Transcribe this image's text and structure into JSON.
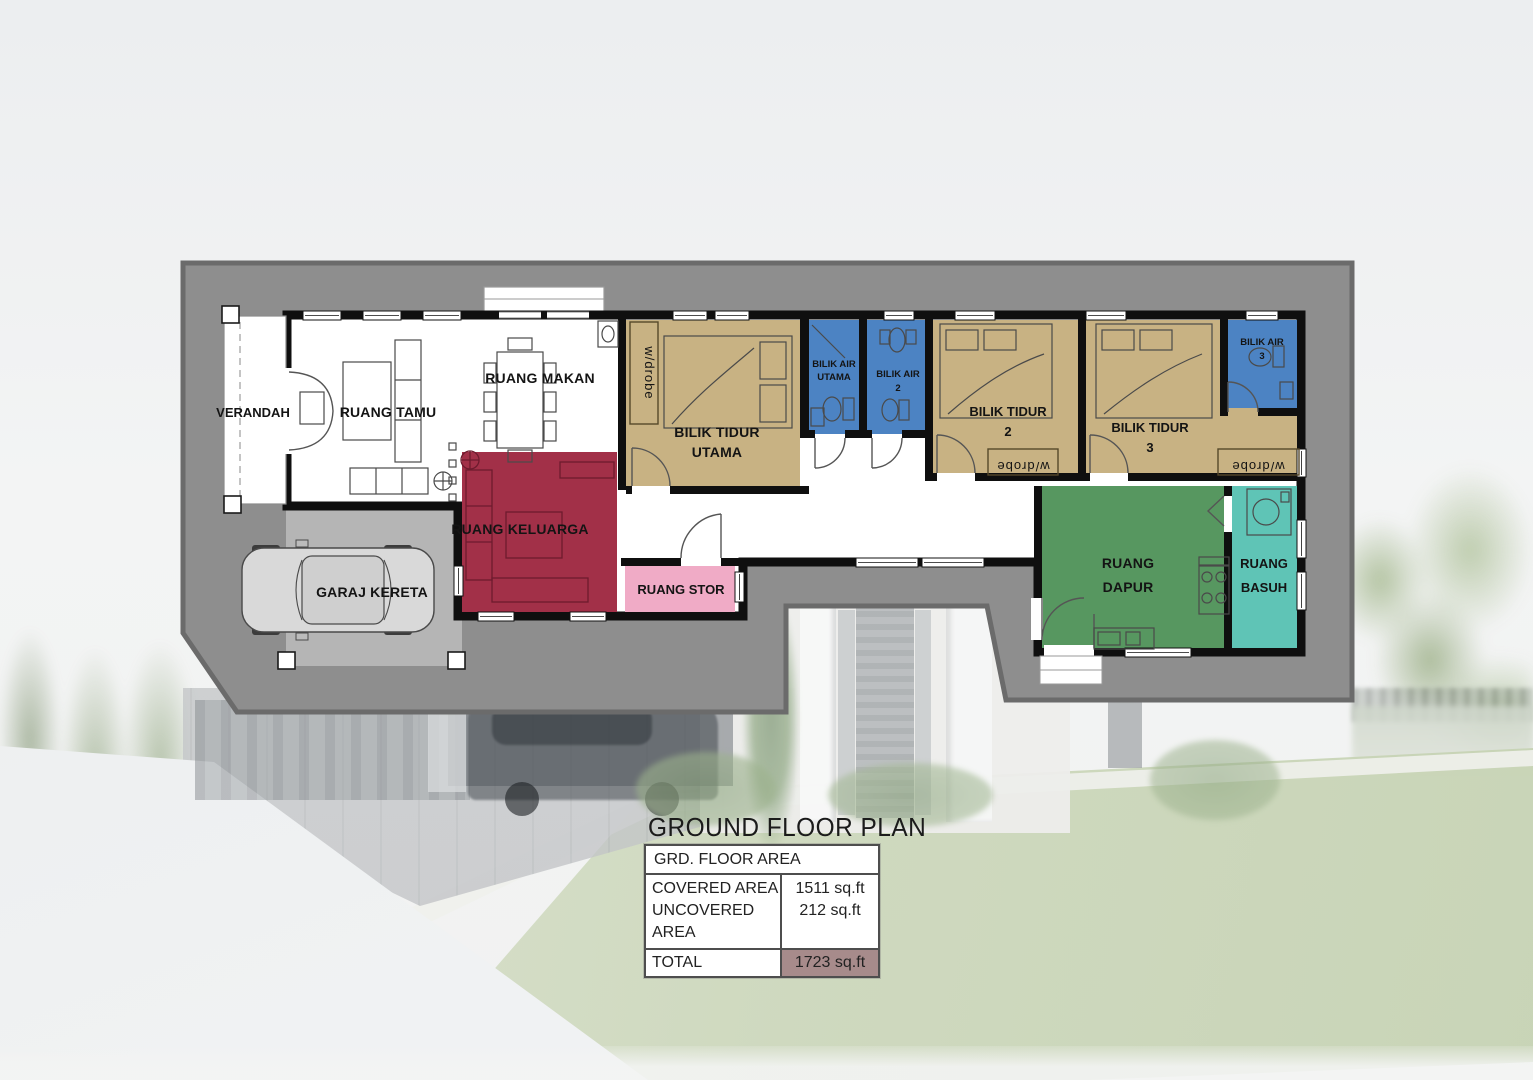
{
  "title": "GROUND FLOOR PLAN",
  "area_table": {
    "header": "GRD. FLOOR AREA",
    "rows": [
      {
        "label": "COVERED AREA",
        "value": "1511 sq.ft"
      },
      {
        "label": "UNCOVERED AREA",
        "value": "212 sq.ft"
      }
    ],
    "total_label": "TOTAL",
    "total_value": "1723 sq.ft"
  },
  "rooms": {
    "verandah": "VERANDAH",
    "ruang_tamu": "RUANG TAMU",
    "ruang_makan": "RUANG MAKAN",
    "garaj_kereta": "GARAJ KERETA",
    "ruang_keluarga": "RUANG KELUARGA",
    "ruang_stor": "RUANG STOR",
    "bilik_tidur": "BILIK TIDUR",
    "bilik_air": "BILIK AIR",
    "utama": "UTAMA",
    "no2": "2",
    "no3": "3",
    "ruang": "RUANG",
    "dapur": "DAPUR",
    "basuh": "BASUH",
    "wardrobe": "w/drobe"
  },
  "colors": {
    "site": "#8e8e8e",
    "site_outline": "#6b6b6b",
    "garage": "#b5b5b5",
    "bedroom": "#c8b283",
    "bathroom": "#4c83c3",
    "family": "#a23048",
    "store": "#f0abc6",
    "kitchen": "#579760",
    "laundry": "#5fc4b6",
    "wall": "#0f0f0f",
    "floor": "#ffffff",
    "total_cell": "#a78b8b"
  }
}
